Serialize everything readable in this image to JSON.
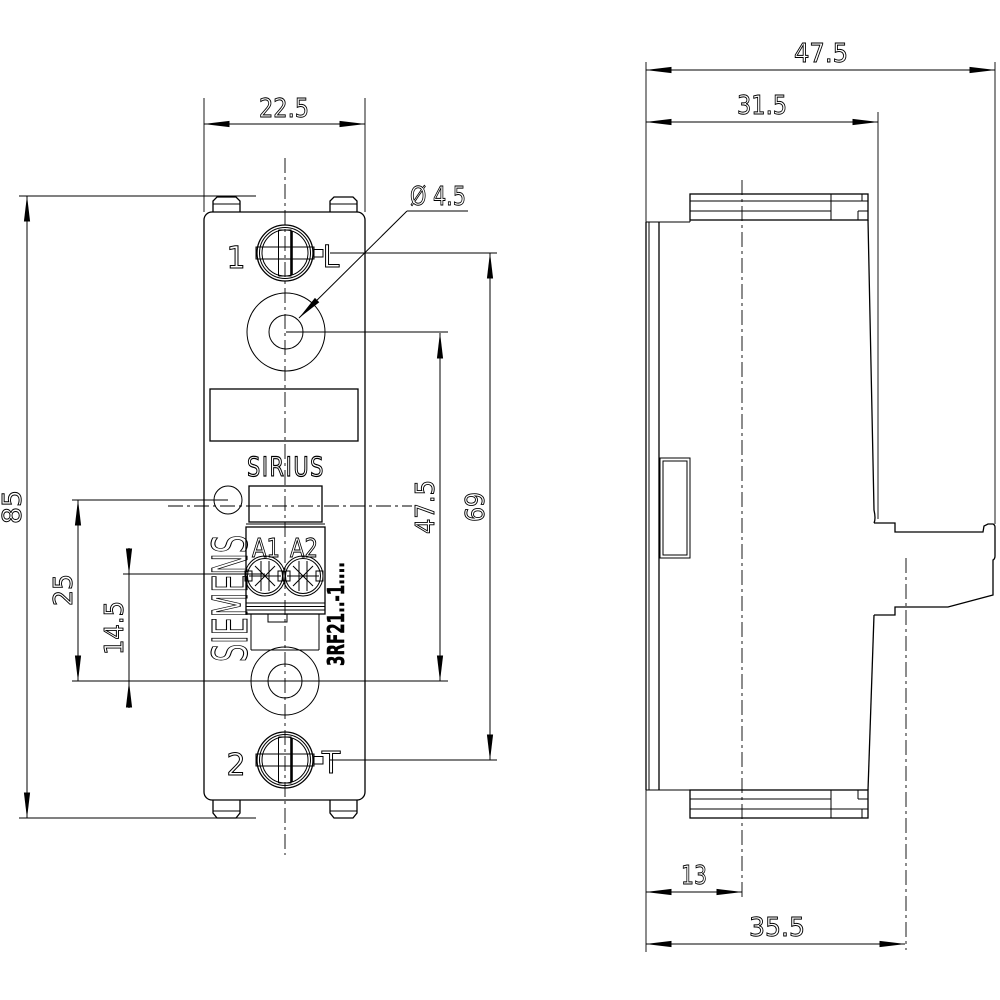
{
  "title": "SIRIUS 3RF21 semiconductor relay dimension drawing",
  "front_view": {
    "labels": {
      "terminal_top_number": "1",
      "terminal_top_letter": "L",
      "terminal_bottom_number": "2",
      "terminal_bottom_letter": "T",
      "product_line": "SIRIUS",
      "brand_vertical": "SIEMENS",
      "coil_terminal_left": "A1",
      "coil_terminal_right": "A2",
      "type_code": "3RF21..-1...."
    },
    "dimensions": {
      "overall_width": "22.5",
      "overall_height": "85",
      "hole_diameter": "Ø 4.5",
      "led_to_hole": "25",
      "coil_screw_to_hole": "14.5",
      "hole_spacing": "47.5",
      "screw_spacing": "69"
    }
  },
  "side_view": {
    "dimensions": {
      "overall_depth": "47.5",
      "body_depth": "31.5",
      "front_to_centerline": "13",
      "front_to_flange_hole": "35.5"
    }
  },
  "colors": {
    "line": "#000000",
    "background": "#ffffff"
  }
}
